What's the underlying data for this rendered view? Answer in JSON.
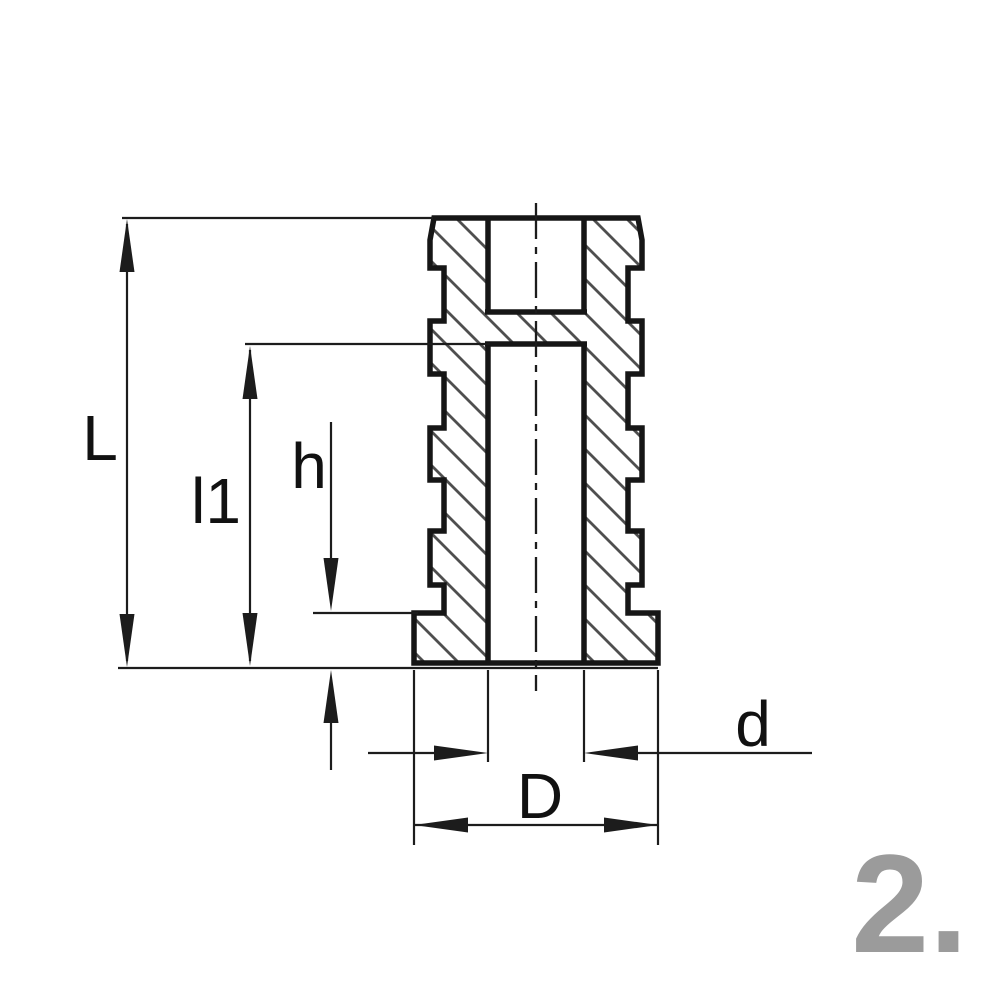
{
  "drawing": {
    "kind": "cross-section technical drawing of a grooved threaded insert",
    "labels": {
      "L": "L",
      "l1": "l1",
      "h": "h",
      "d": "d",
      "D": "D"
    },
    "step_number": "2.",
    "colors": {
      "outline": "#161616",
      "thin_line": "#1c1c1c",
      "hatch": "#4f4f4f",
      "label_text": "#111111",
      "step_number_text": "#9b9b9b",
      "background": "#ffffff"
    }
  }
}
